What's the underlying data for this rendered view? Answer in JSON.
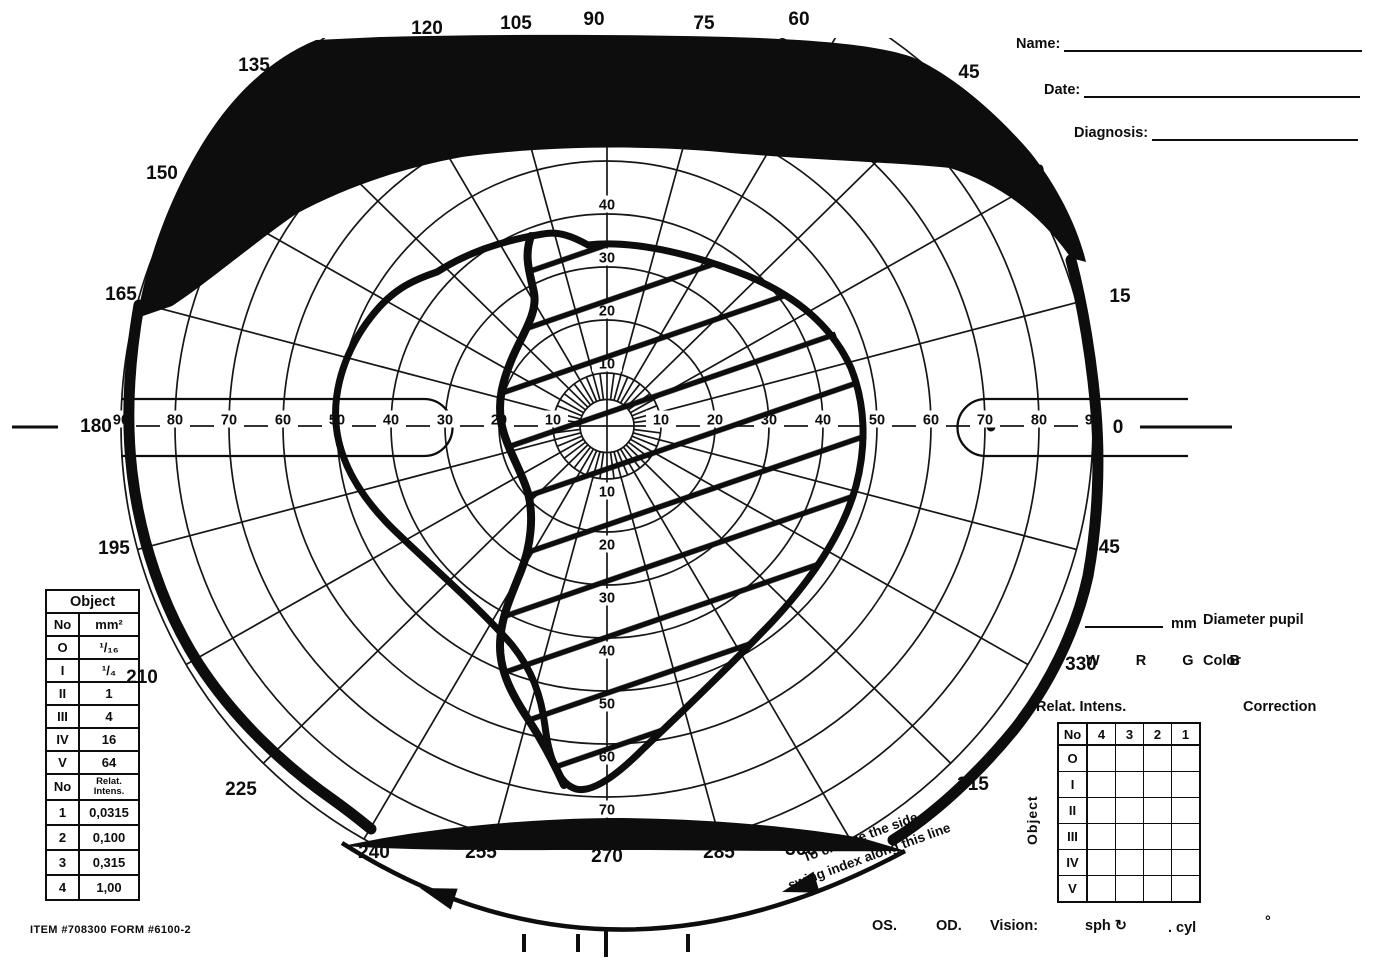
{
  "form": {
    "name_label": "Name:",
    "date_label": "Date:",
    "diagnosis_label": "Diagnosis:",
    "item_number": "ITEM #708300 FORM #6100-2",
    "diameter_pupil": {
      "unit": "mm",
      "label": "Diameter pupil"
    },
    "color_row": {
      "letters": "W R G B",
      "label": "Color"
    },
    "correction_label": "Correction",
    "relat_intens_title": "Relat. Intens.",
    "bottom_row": {
      "os": "OS.",
      "od": "OD.",
      "vision": "Vision:",
      "sph": "sph ↻",
      "cyl": ". cyl",
      "degree": "°"
    },
    "swing_note_line1": "To change the side,",
    "swing_note_line2": "swing index along this line"
  },
  "object_table": {
    "title": "Object",
    "col_headers": [
      "No",
      "mm²"
    ],
    "size_rows": [
      [
        "O",
        "¹/₁₆"
      ],
      [
        "I",
        "¹/₄"
      ],
      [
        "II",
        "1"
      ],
      [
        "III",
        "4"
      ],
      [
        "IV",
        "16"
      ],
      [
        "V",
        "64"
      ]
    ],
    "intens_header": [
      "No",
      "Relat.|Intens."
    ],
    "intens_rows": [
      [
        "1",
        "0,0315"
      ],
      [
        "2",
        "0,100"
      ],
      [
        "3",
        "0,315"
      ],
      [
        "4",
        "1,00"
      ]
    ]
  },
  "relat_table": {
    "col_headers": [
      "No",
      "4",
      "3",
      "2",
      "1"
    ],
    "row_headers": [
      "O",
      "I",
      "II",
      "III",
      "IV",
      "V"
    ],
    "side_label": "Object"
  },
  "chart_data": {
    "type": "polar-visual-field",
    "title": "Goldmann kinetic perimetry chart with plotted visual field defect",
    "layout": {
      "cx": 607,
      "cy": 426,
      "px_per_deg_x": 5.4,
      "px_per_deg_y": 5.3,
      "clip_top": 38,
      "clip_bottom": 847,
      "grid_on": true
    },
    "radial_rings_deg": [
      10,
      20,
      30,
      40,
      50,
      60,
      70,
      80,
      90
    ],
    "inner_ring_deg": 5,
    "meridian_step_deg": 15,
    "fine_spoke_step_deg": 7.5,
    "ring_labels": {
      "horizontal": [
        10,
        20,
        30,
        40,
        50,
        60,
        70,
        80,
        90
      ],
      "vertical_up": [
        10,
        20,
        30,
        40
      ],
      "vertical_down": [
        10,
        20,
        30,
        40,
        50,
        60,
        70
      ]
    },
    "meridian_labels": [
      {
        "t": "0",
        "x": 1118,
        "y": 426
      },
      {
        "t": "15",
        "x": 1120,
        "y": 295
      },
      {
        "t": "30",
        "x": 1034,
        "y": 171
      },
      {
        "t": "45",
        "x": 969,
        "y": 71
      },
      {
        "t": "60",
        "x": 799,
        "y": 18
      },
      {
        "t": "75",
        "x": 704,
        "y": 22
      },
      {
        "t": "90",
        "x": 594,
        "y": 18
      },
      {
        "t": "105",
        "x": 516,
        "y": 22
      },
      {
        "t": "120",
        "x": 427,
        "y": 27
      },
      {
        "t": "135",
        "x": 254,
        "y": 64
      },
      {
        "t": "150",
        "x": 162,
        "y": 172
      },
      {
        "t": "165",
        "x": 121,
        "y": 293
      },
      {
        "t": "180",
        "x": 96,
        "y": 425
      },
      {
        "t": "195",
        "x": 114,
        "y": 547
      },
      {
        "t": "210",
        "x": 142,
        "y": 676
      },
      {
        "t": "225",
        "x": 241,
        "y": 788
      },
      {
        "t": "240",
        "x": 374,
        "y": 851
      },
      {
        "t": "255",
        "x": 481,
        "y": 851
      },
      {
        "t": "270",
        "x": 607,
        "y": 855
      },
      {
        "t": "285",
        "x": 719,
        "y": 851
      },
      {
        "t": "300",
        "x": 801,
        "y": 848
      },
      {
        "t": "315",
        "x": 973,
        "y": 783
      },
      {
        "t": "330",
        "x": 1081,
        "y": 663
      },
      {
        "t": "345",
        "x": 1104,
        "y": 546
      }
    ],
    "plotted_elements": [
      {
        "name": "superior-scotoma",
        "style": "solid-black-fill",
        "extent": "from meridian ~135° to ~45°, between ~58–65° eccentricity and the top chart edge"
      },
      {
        "name": "inferior-arcuate-scotoma",
        "style": "solid-black-fill",
        "extent": "meridians 240°–300° at ~75–80° eccentricity"
      },
      {
        "name": "peripheral-isopter",
        "style": "thick hand-drawn stroke",
        "radius_by_angle_deg": {
          "0": 90,
          "90": "clipped by superior scotoma",
          "180": 88,
          "270": 79
        }
      },
      {
        "name": "mid-isopter",
        "style": "thick hand-drawn closed curve",
        "radius_by_angle_deg": {
          "0": 47,
          "45": 38,
          "90": 36,
          "135": 42,
          "180": 50,
          "225": 44,
          "270": 69,
          "315": 48
        }
      },
      {
        "name": "central-island",
        "style": "diagonal-hatch fill",
        "left_border": "wavy vertical line at ~15–20° nasal of fixation",
        "right_border": "coincides with mid-isopter temporal edge"
      }
    ],
    "hatch": {
      "angle_deg": -19,
      "spacing_px": 53
    },
    "blind_spot_channels": "stadium-shaped capsules on horizontal meridian, 70–90° both sides",
    "ink_color": "#0d0d0d",
    "paper_color": "#ffffff"
  }
}
